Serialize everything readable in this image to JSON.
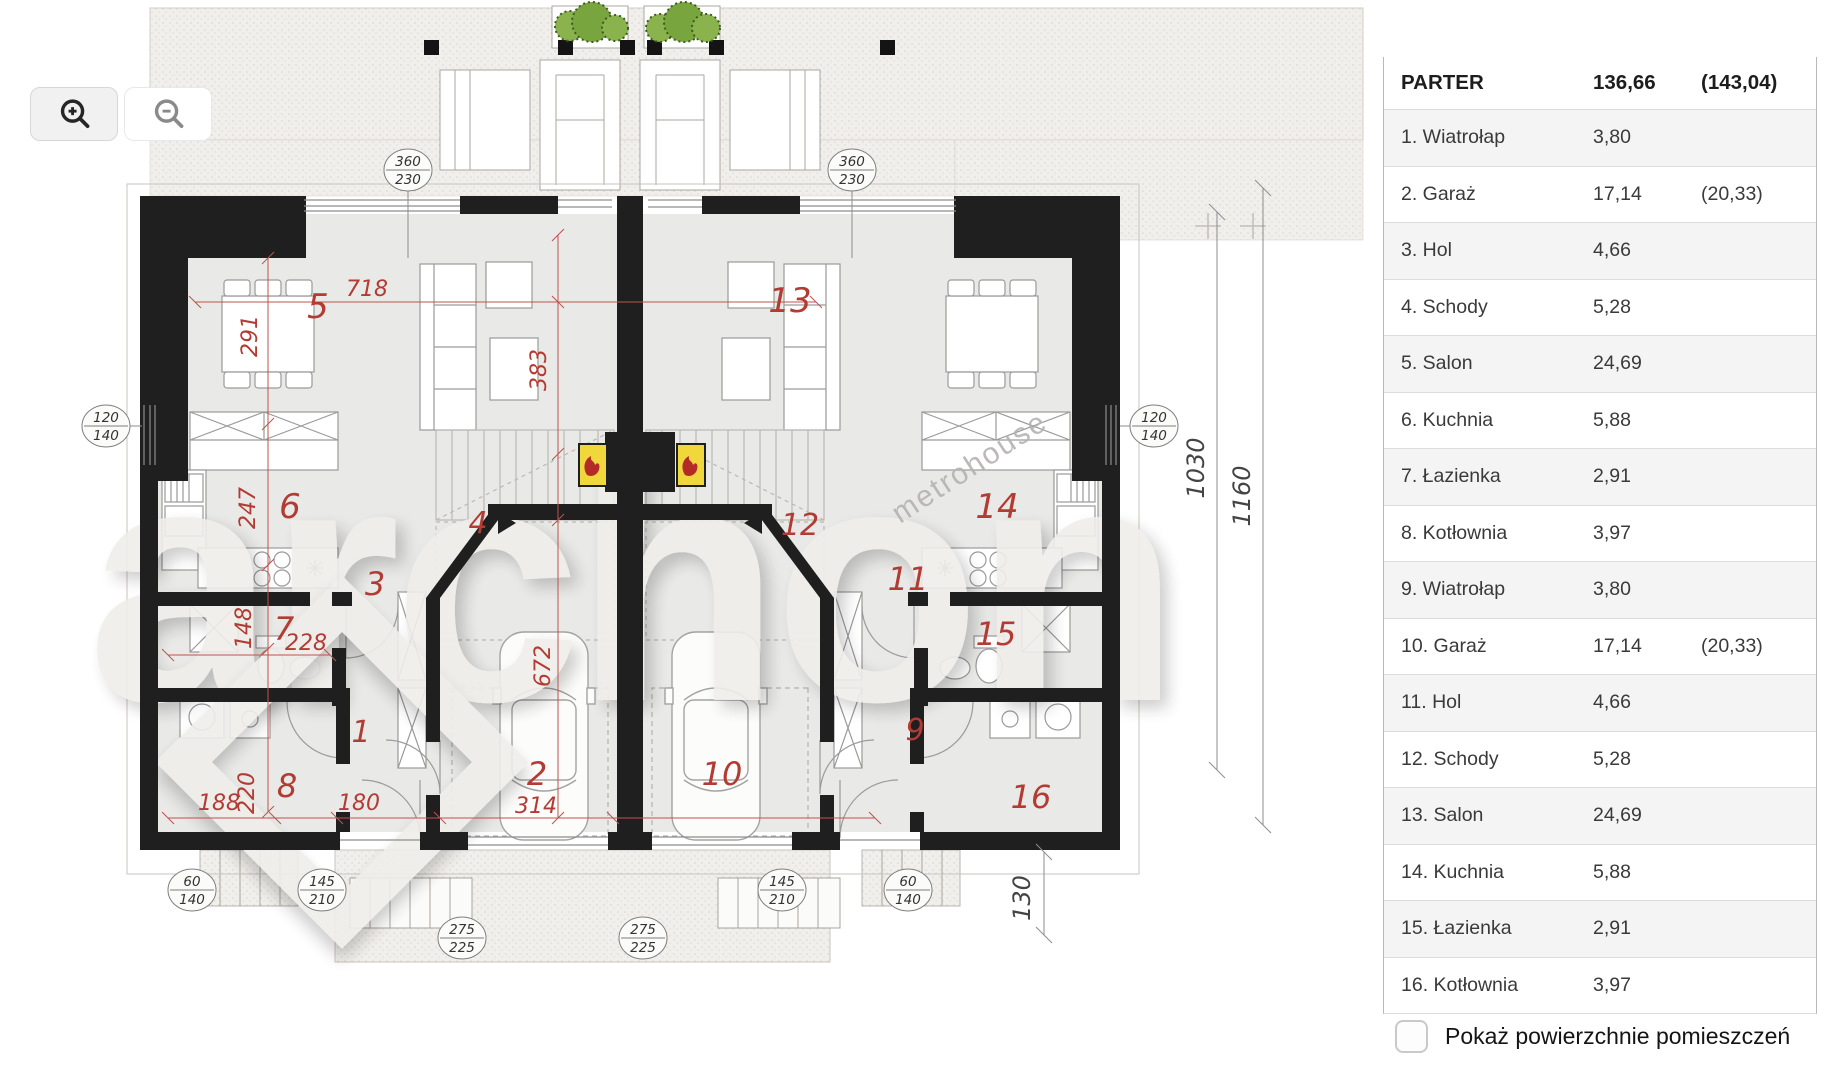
{
  "toolbar": {
    "zoom_in_icon": "magnifier-plus",
    "zoom_out_icon": "magnifier-minus"
  },
  "panel": {
    "header": {
      "title": "PARTER",
      "area": "136,66",
      "area_gross": "(143,04)"
    },
    "rows": [
      {
        "label": "1. Wiatrołap",
        "area": "3,80",
        "area_gross": ""
      },
      {
        "label": "2. Garaż",
        "area": "17,14",
        "area_gross": "(20,33)"
      },
      {
        "label": "3. Hol",
        "area": "4,66",
        "area_gross": ""
      },
      {
        "label": "4. Schody",
        "area": "5,28",
        "area_gross": ""
      },
      {
        "label": "5. Salon",
        "area": "24,69",
        "area_gross": ""
      },
      {
        "label": "6. Kuchnia",
        "area": "5,88",
        "area_gross": ""
      },
      {
        "label": "7. Łazienka",
        "area": "2,91",
        "area_gross": ""
      },
      {
        "label": "8. Kotłownia",
        "area": "3,97",
        "area_gross": ""
      },
      {
        "label": "9. Wiatrołap",
        "area": "3,80",
        "area_gross": ""
      },
      {
        "label": "10. Garaż",
        "area": "17,14",
        "area_gross": "(20,33)"
      },
      {
        "label": "11. Hol",
        "area": "4,66",
        "area_gross": ""
      },
      {
        "label": "12. Schody",
        "area": "5,28",
        "area_gross": ""
      },
      {
        "label": "13. Salon",
        "area": "24,69",
        "area_gross": ""
      },
      {
        "label": "14. Kuchnia",
        "area": "5,88",
        "area_gross": ""
      },
      {
        "label": "15. Łazienka",
        "area": "2,91",
        "area_gross": ""
      },
      {
        "label": "16. Kotłownia",
        "area": "3,97",
        "area_gross": ""
      }
    ],
    "checkbox": {
      "label": "Pokaż powierzchnie pomieszczeń",
      "checked": false
    }
  },
  "plan": {
    "floor_name": "PARTER",
    "room_labels": {
      "r1": "1",
      "r2": "2",
      "r3": "3",
      "r4": "4",
      "r5": "5",
      "r6": "6",
      "r7": "7",
      "r8": "8",
      "r9": "9",
      "r10": "10",
      "r11": "11",
      "r12": "12",
      "r13": "13",
      "r14": "14",
      "r15": "15",
      "r16": "16"
    },
    "dims": {
      "d718": "718",
      "d291": "291",
      "d383": "383",
      "d247": "247",
      "d148": "148",
      "d228": "228",
      "d220": "220",
      "d188": "188",
      "d180": "180",
      "d314": "314",
      "d672": "672",
      "d1030": "1030",
      "d1160": "1160",
      "d130": "130"
    },
    "badges": [
      {
        "top": "360",
        "bottom": "230"
      },
      {
        "top": "360",
        "bottom": "230"
      },
      {
        "top": "120",
        "bottom": "140"
      },
      {
        "top": "120",
        "bottom": "140"
      },
      {
        "top": "60",
        "bottom": "140"
      },
      {
        "top": "145",
        "bottom": "210"
      },
      {
        "top": "275",
        "bottom": "225"
      },
      {
        "top": "275",
        "bottom": "225"
      },
      {
        "top": "145",
        "bottom": "210"
      },
      {
        "top": "60",
        "bottom": "140"
      }
    ],
    "watermark": {
      "brand": "archon",
      "partner": "metrohouse"
    },
    "colors": {
      "wall": "#1f1f1f",
      "label_red": "#b23b33",
      "fireplace_yellow": "#f0d73c",
      "plant_green": "#86b04a",
      "floor": "#e9e9e7"
    }
  }
}
